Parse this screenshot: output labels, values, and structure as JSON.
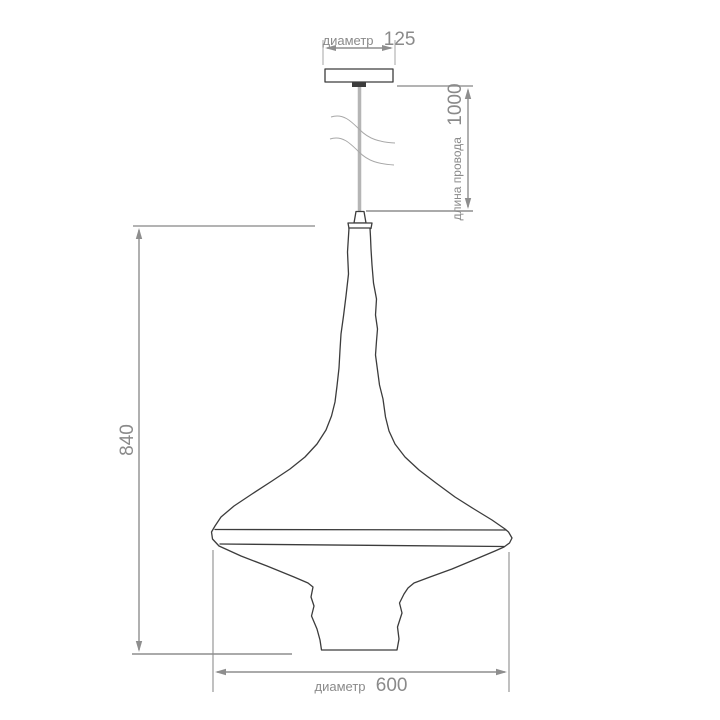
{
  "drawing": {
    "type": "pendant-lamp-dimension-drawing",
    "background": "#ffffff",
    "colors": {
      "outline": "#3c3c3c",
      "dimension": "#8e8e8e",
      "extension": "#b3b3b3",
      "cord": "#b5b5b5",
      "break_line": "#a8a8a8",
      "text": "#8a8a8a",
      "lamp_fill": "#ffffff"
    },
    "dimensions": {
      "canopy_diameter": {
        "label": "диаметр",
        "value": "125"
      },
      "cord_length": {
        "label": "длина провода",
        "value": "1000"
      },
      "shade_height": {
        "value": "840"
      },
      "shade_diameter": {
        "label": "диаметр",
        "value": "600"
      }
    }
  }
}
